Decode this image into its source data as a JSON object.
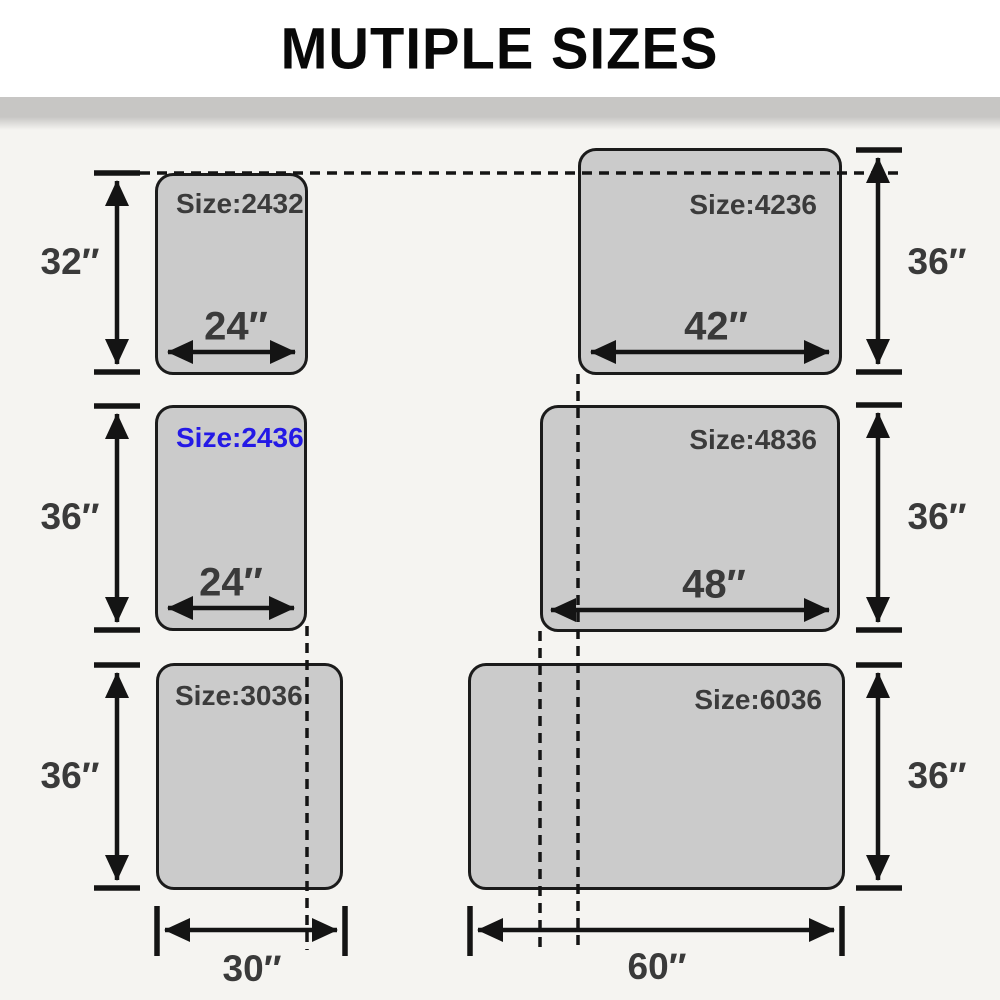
{
  "title": "MUTIPLE SIZES",
  "colors": {
    "accent_blue": "#2419e6",
    "panel_fill": "#cbcbcb",
    "panel_border": "#1b1b1b",
    "line_color": "#141414",
    "text_dark": "#3a3a3a",
    "background": "#f5f4f1",
    "divider_gray": "#c7c6c4"
  },
  "panels": [
    {
      "code": "2432",
      "size_label": "Size:2432",
      "width_label": "24″",
      "height_label": "32″",
      "width_in": 24,
      "height_in": 32,
      "label_color": "dark"
    },
    {
      "code": "4236",
      "size_label": "Size:4236",
      "width_label": "42″",
      "height_label": "36″",
      "width_in": 42,
      "height_in": 36,
      "label_color": "dark"
    },
    {
      "code": "2436",
      "size_label": "Size:2436",
      "width_label": "24″",
      "height_label": "36″",
      "width_in": 24,
      "height_in": 36,
      "label_color": "blue"
    },
    {
      "code": "4836",
      "size_label": "Size:4836",
      "width_label": "48″",
      "height_label": "36″",
      "width_in": 48,
      "height_in": 36,
      "label_color": "dark"
    },
    {
      "code": "3036",
      "size_label": "Size:3036",
      "width_label": "30″",
      "height_label": "36″",
      "width_in": 30,
      "height_in": 36,
      "label_color": "dark"
    },
    {
      "code": "6036",
      "size_label": "Size:6036",
      "width_label": "60″",
      "height_label": "36″",
      "width_in": 60,
      "height_in": 36,
      "label_color": "dark"
    }
  ]
}
